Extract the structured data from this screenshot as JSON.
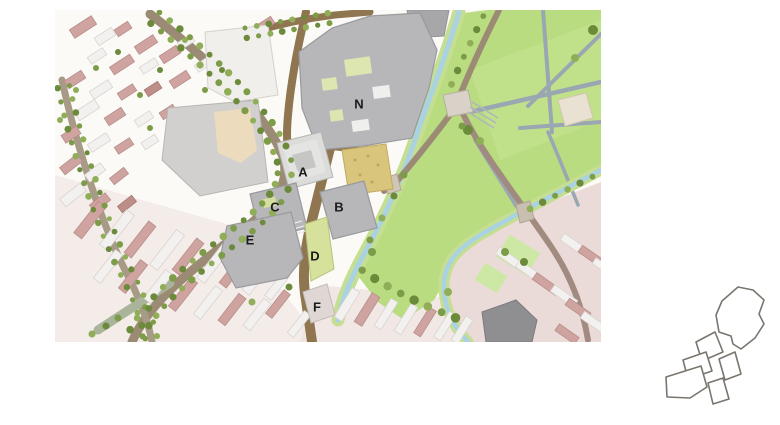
{
  "figure": {
    "type": "masterplan-site-map",
    "description": "Urban redevelopment site plan: grey new-build blocks around a tan market square, bounded by a tree-lined avenue, a stream and a large green park; key-plan outline inset at bottom right.",
    "block_labels": [
      "N",
      "A",
      "B",
      "C",
      "D",
      "E",
      "F"
    ]
  },
  "map": {
    "blocks": [
      {
        "label": "N",
        "x": 359,
        "y": 104
      },
      {
        "label": "A",
        "x": 303,
        "y": 172
      },
      {
        "label": "B",
        "x": 339,
        "y": 207
      },
      {
        "label": "C",
        "x": 275,
        "y": 207
      },
      {
        "label": "D",
        "x": 315,
        "y": 256
      },
      {
        "label": "E",
        "x": 250,
        "y": 240
      },
      {
        "label": "F",
        "x": 317,
        "y": 307
      }
    ],
    "colors": {
      "map_base": "#fbfaf7",
      "park_green": "#b9dc80",
      "light_green_patch": "#cde8a0",
      "stream_blue": "#a9d2e2",
      "bank_green": "#c6de92",
      "block_gray": "#b7b7ba",
      "block_light": "#e4e4e2",
      "courtyard_gray": "#c6c6c4",
      "road_brown": "#8f7550",
      "avenue_brown": "#9b8a74",
      "square_tan": "#d9c57c",
      "existing_pink": "#cfa39f",
      "existing_white": "#f3f1ef",
      "parcel_green": "#d6e29c",
      "parcel_pale": "#ded7d3",
      "path_gray": "#9aa7b2",
      "dark_building": "#8f8f91",
      "label_color": "#1c1c1c",
      "inset_outline": "#7a756e"
    }
  },
  "inset": {
    "name": "key-plan",
    "shapes": [
      "N",
      "A",
      "C",
      "E",
      "B",
      "D"
    ]
  }
}
